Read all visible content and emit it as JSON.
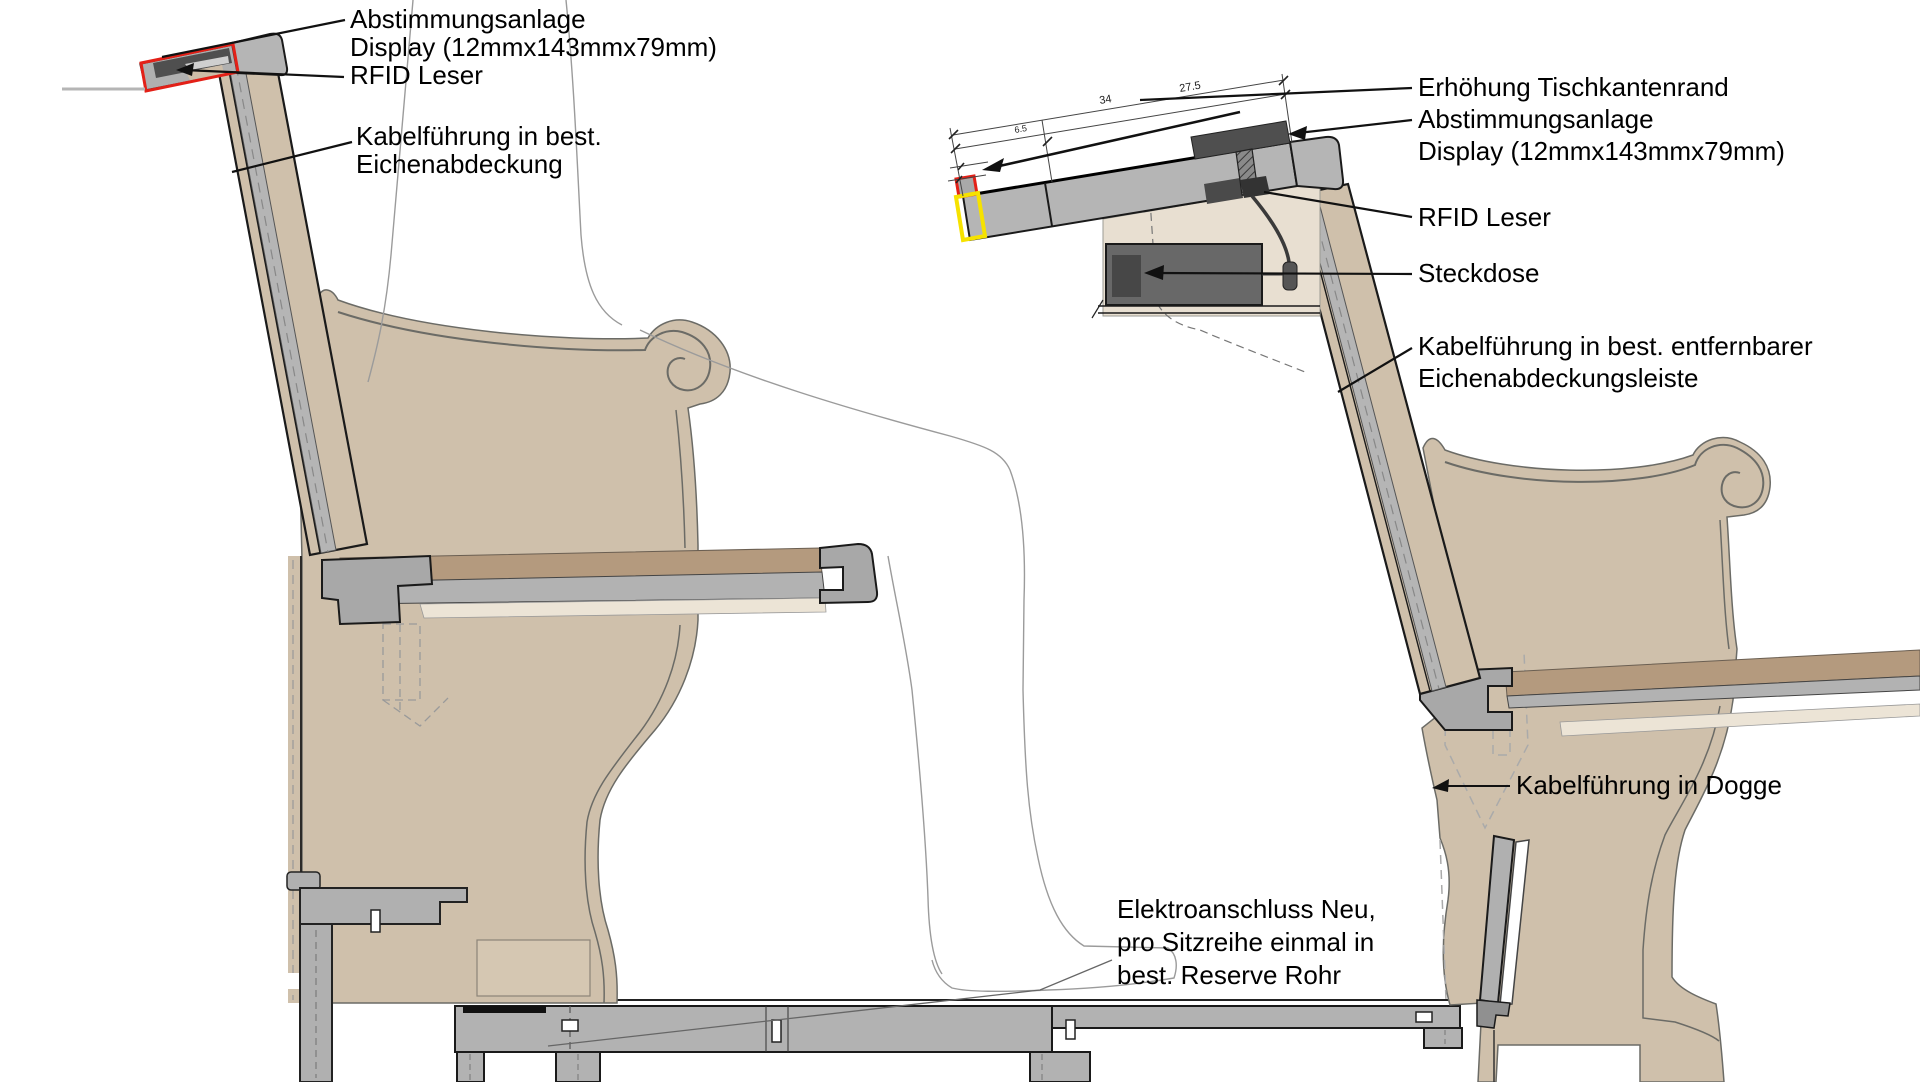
{
  "drawing": {
    "type": "technical-section-seating",
    "left_labels": {
      "abstimmungsanlage": "Abstimmungsanlage",
      "display": "Display (12mmx143mmx79mm)",
      "rfid": "RFID Leser",
      "kabel_line1": "Kabelführung in best.",
      "kabel_line2": "Eichenabdeckung"
    },
    "right_labels": {
      "erhoehung": "Erhöhung Tischkantenrand",
      "abstimmungsanlage": "Abstimmungsanlage",
      "display": "Display (12mmx143mmx79mm)",
      "rfid": "RFID Leser",
      "steckdose": "Steckdose",
      "kabel_line1": "Kabelführung in best. entfernbarer",
      "kabel_line2": "Eichenabdeckungsleiste",
      "dogge": "Kabelführung in Dogge"
    },
    "bottom_labels": {
      "elektro_line1": "Elektroanschluss Neu,",
      "elektro_line2": "pro Sitzreihe einmal in",
      "elektro_line3": "best. Reserve Rohr"
    },
    "dimensions": {
      "d1": "34",
      "d2": "27.5",
      "d3": "6.5"
    },
    "colors": {
      "marker_red": "#e32017",
      "marker_yellow": "#f6e200",
      "wood_tan": "#cfc0ab",
      "seat_brown": "#b49a7e",
      "structure_gray": "#b2b2b2",
      "display_dark": "#4f4f4f",
      "socket_gray": "#686868",
      "cream": "#ece4d6",
      "panel_light": "#e8dfd1"
    }
  }
}
